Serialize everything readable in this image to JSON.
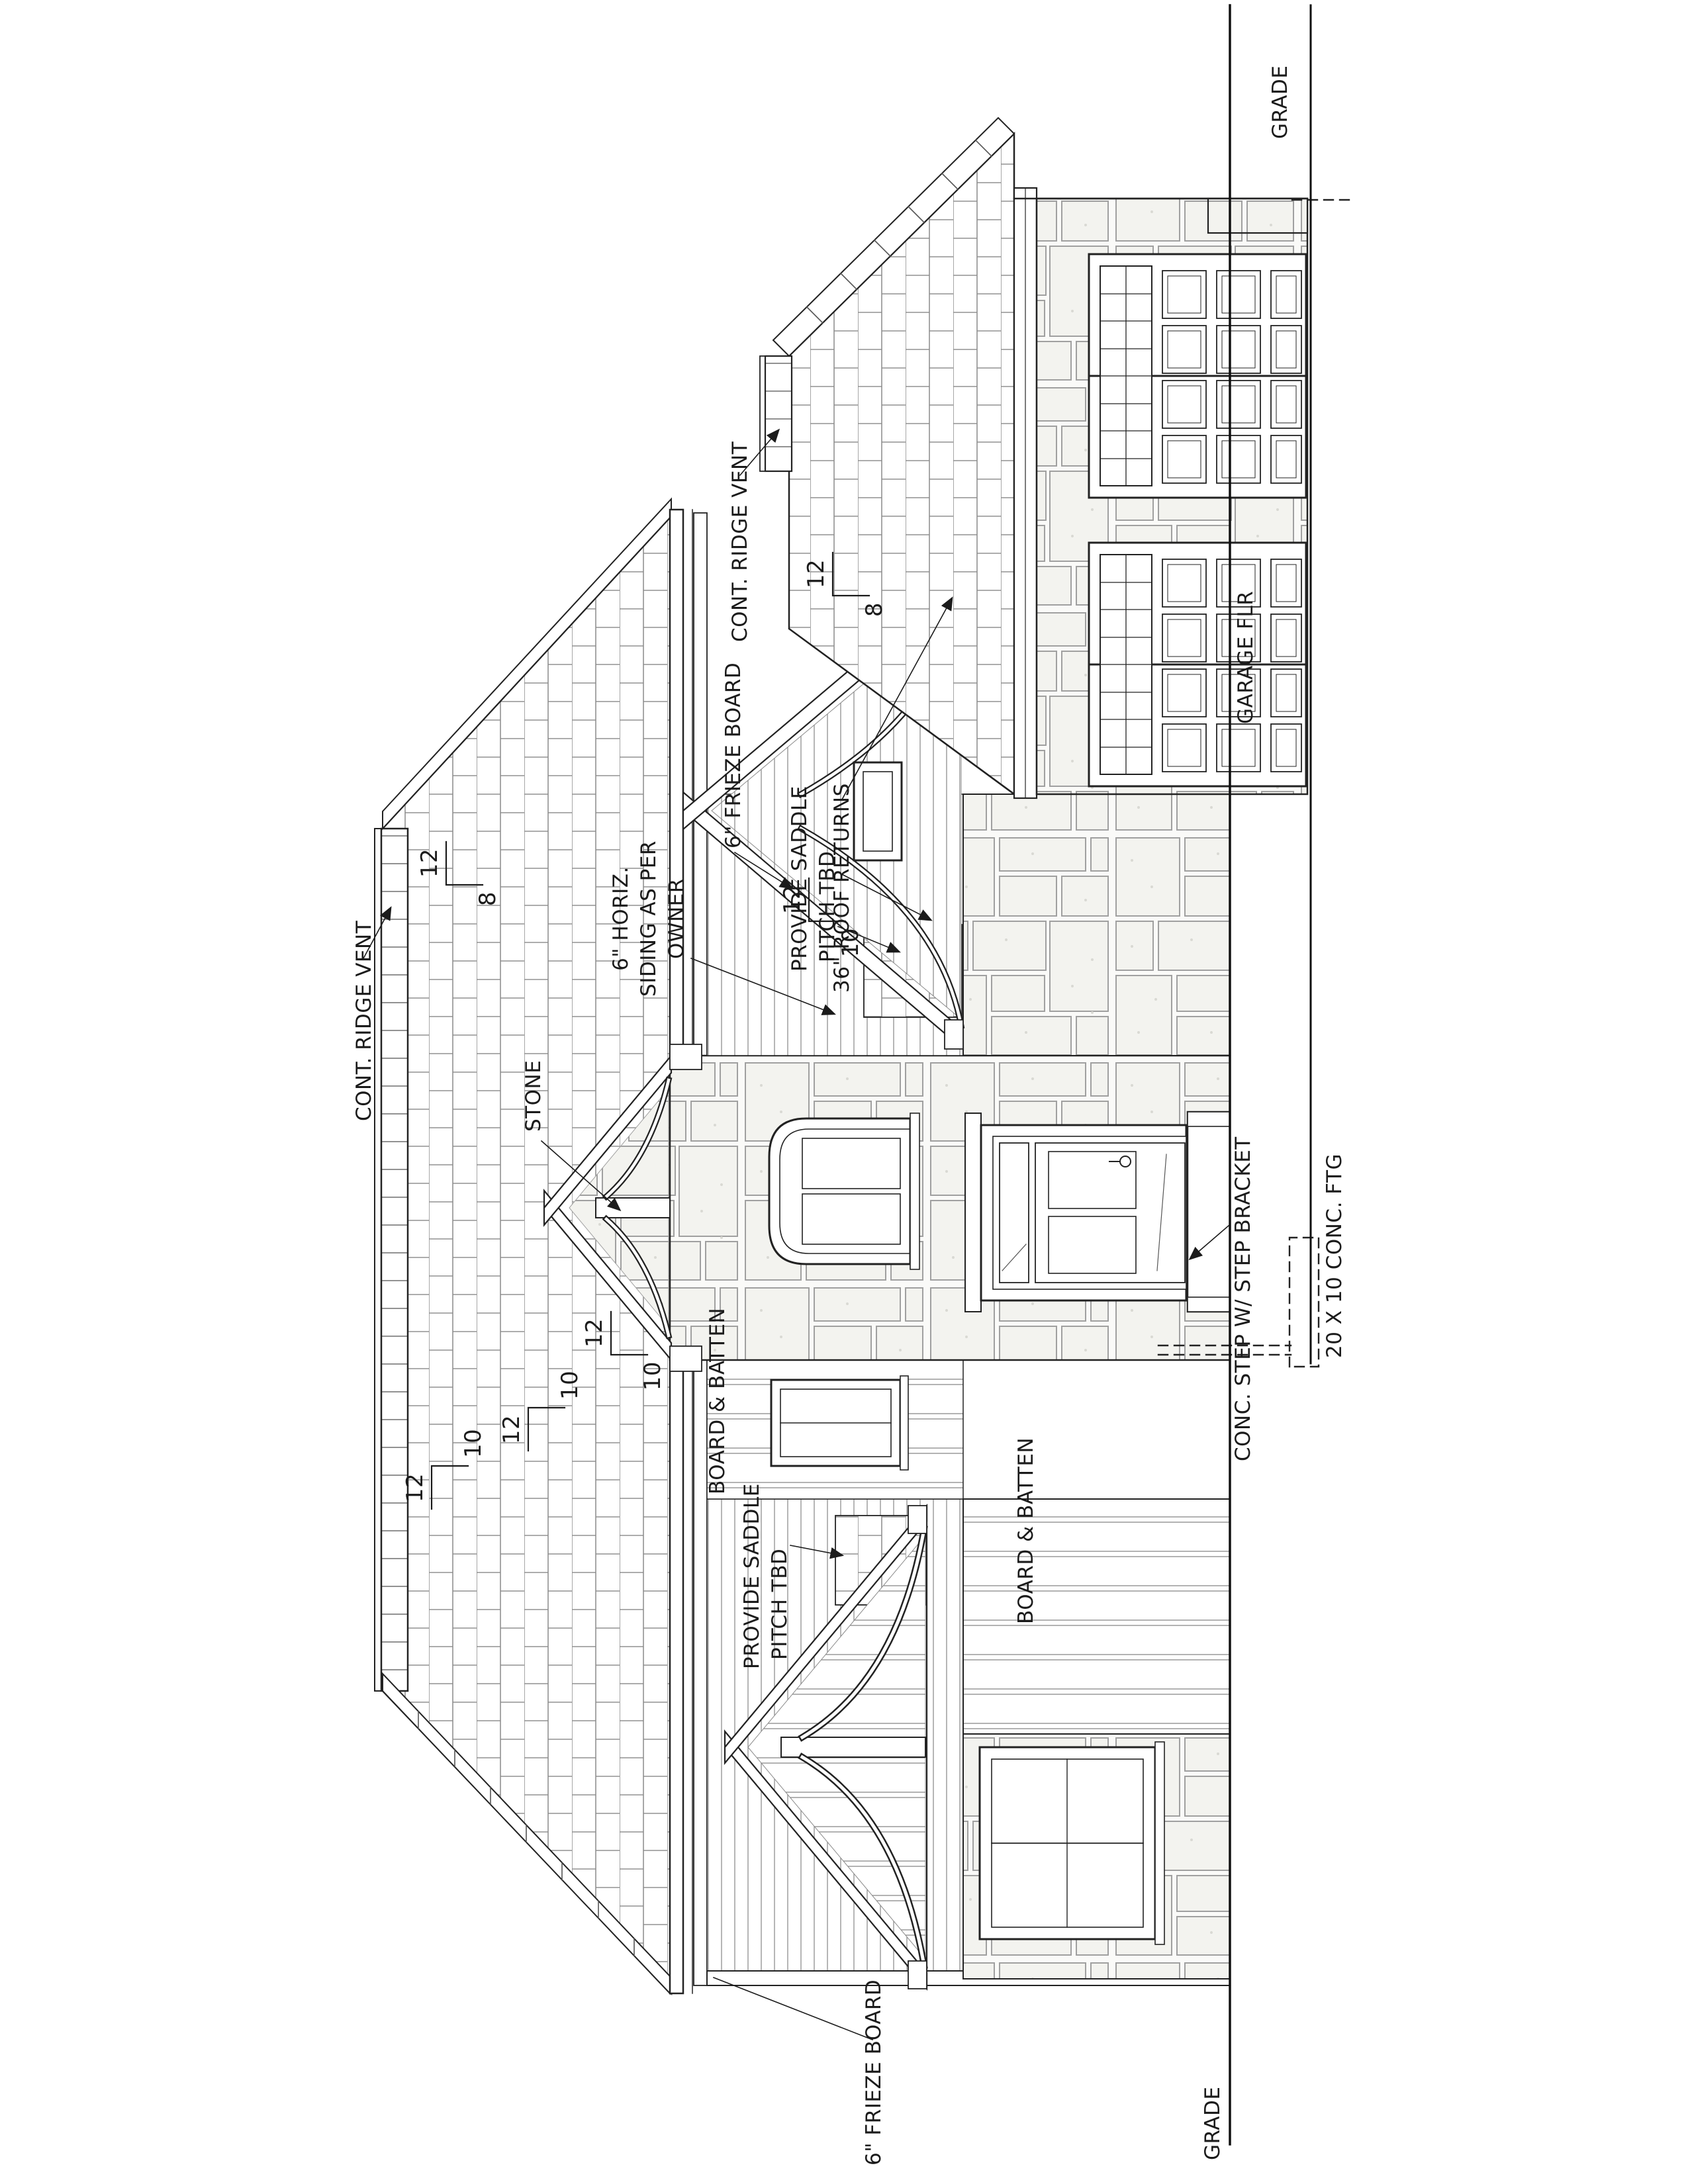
{
  "sheet": {
    "type": "architectural-front-elevation",
    "background": "#ffffff",
    "line_color": "#222222",
    "pattern_line_color": "#8a8a8a",
    "stone_joint_color": "#a0a0a0"
  },
  "labels": {
    "grade_left": "GRADE",
    "grade_right": "GRADE",
    "garage_floor": "GARAGE FLR",
    "ridge_vent_main": "CONT. RIDGE VENT",
    "ridge_vent_right": "CONT. RIDGE VENT",
    "frieze_upper": "6\" FRIEZE BOARD",
    "frieze_left": "6\" FRIEZE BOARD",
    "siding_line1": "6\" HORIZ.",
    "siding_line2": "SIDING AS PER",
    "siding_line3": "OWNER",
    "saddle1_line1": "PROVIDE SADDLE",
    "saddle1_line2": "PITCH TBD",
    "saddle2_line1": "PROVIDE SADDLE",
    "saddle2_line2": "PITCH TBD",
    "roof_returns": "36\" ROOF RETURNS",
    "stone": "STONE",
    "board_batten_upper": "BOARD & BATTEN",
    "board_batten_lower": "BOARD & BATTEN",
    "conc_step": "CONC. STEP W/ STEP BRACKET",
    "footing": "20 X 10 CONC. FTG"
  },
  "pitch_markers": [
    {
      "run": "12",
      "rise": "8"
    },
    {
      "run": "12",
      "rise": "8"
    },
    {
      "run": "12",
      "rise": "10"
    },
    {
      "run": "12",
      "rise": "10"
    },
    {
      "run": "12",
      "rise": "10"
    },
    {
      "run": "12",
      "rise": "10"
    }
  ]
}
